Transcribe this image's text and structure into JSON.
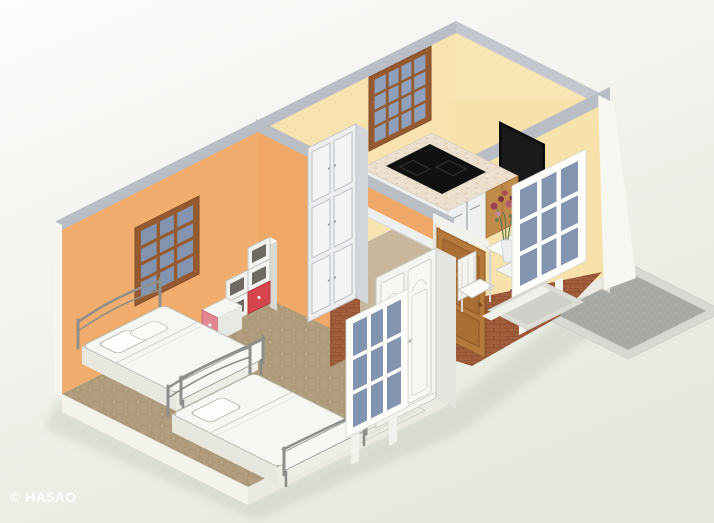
{
  "watermark": {
    "text": "© HA5AO"
  },
  "scene": {
    "type": "isometric-3d-floor-plan-render",
    "style": "cutaway dollhouse view of a small apartment",
    "rooms": [
      {
        "name": "bedroom",
        "wall_color": "#F1AD6D",
        "floor": "tan patterned carpet",
        "window": "brown frame, 3x4 blue panes",
        "furniture": [
          "double bed with white bedding",
          "double bed with white bedding",
          "cube step shelf with red drawers",
          "nightstand with red drawer front"
        ]
      },
      {
        "name": "kitchen",
        "wall_color": "#F8E3AE",
        "window": "brown frame, 4x4 blue panes",
        "furniture": [
          "counter with black cooktop and marble top",
          "white base cabinets",
          "oak base cabinet",
          "tall white cabinet unit"
        ]
      },
      {
        "name": "entry-hall",
        "wall_color": "#F7E2AC",
        "floor": "terracotta brick",
        "furniture": [
          "wall-mounted black tv",
          "white console table with flower vase",
          "white chair",
          "white arched wardrobe",
          "oak panel entry door"
        ]
      }
    ],
    "floating_windows": [
      "white frame 3x3 blue panes (front of bedroom)",
      "white frame 3x3 blue panes (front of entry)"
    ],
    "exterior": {
      "walkway": "gray concrete mat with light border",
      "exterior_walls": "#F6F6F0",
      "wall_caps": "#B9BDC5"
    },
    "palette": {
      "background_top": "#FDFDFC",
      "background_bottom": "#E6E9DE",
      "orange_wall": "#F1AD6D",
      "cream_wall": "#F8E3AE",
      "cap_gray": "#B9BDC5",
      "carpet": "#B19E7E",
      "terracotta": "#A25E3C",
      "patio_gray": "#A8AAA5",
      "red_drawer": "#D5454E",
      "pink_drawer": "#E28791",
      "oak": "#B5793C",
      "pane_blue": "#8394B0",
      "tv_black": "#0B0B0B",
      "mattress": "#F6F6F2"
    }
  }
}
